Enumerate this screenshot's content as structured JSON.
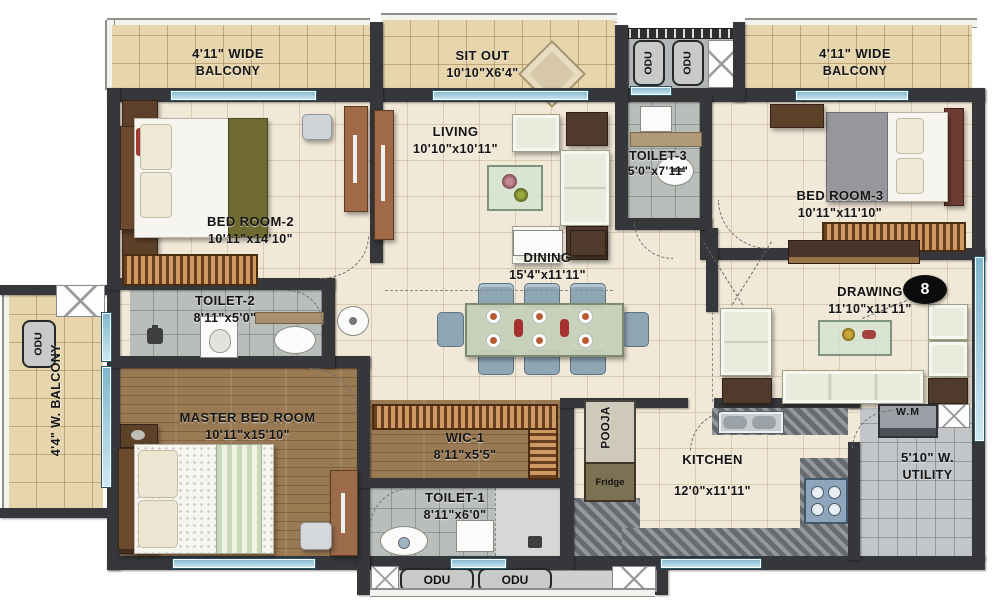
{
  "rooms": {
    "balcony_tl": {
      "label": "4'11\" WIDE",
      "sub": "BALCONY"
    },
    "sit_out": {
      "label": "SIT OUT",
      "sub": "10'10\"X6'4\""
    },
    "balcony_tr": {
      "label": "4'11\" WIDE",
      "sub": "BALCONY"
    },
    "living": {
      "label": "LIVING",
      "sub": "10'10\"x10'11\""
    },
    "toilet3": {
      "label": "TOILET-3",
      "sub": "5'0\"x7'11\""
    },
    "bedroom2": {
      "label": "BED ROOM-2",
      "sub": "10'11\"x14'10\""
    },
    "bedroom3": {
      "label": "BED ROOM-3",
      "sub": "10'11\"x11'10\""
    },
    "toilet2": {
      "label": "TOILET-2",
      "sub": "8'11\"x5'0\""
    },
    "dining": {
      "label": "DINING",
      "sub": "15'4\"x11'11\""
    },
    "drawing": {
      "label": "DRAWING",
      "sub": "11'10\"x11'11\""
    },
    "balcony_left": {
      "label": "4'4\" W. BALCONY"
    },
    "master": {
      "label": "MASTER BED ROOM",
      "sub": "10'11\"x15'10\""
    },
    "wic1": {
      "label": "WIC-1",
      "sub": "8'11\"x5'5\""
    },
    "toilet1": {
      "label": "TOILET-1",
      "sub": "8'11\"x6'0\""
    },
    "pooja": {
      "label": "POOJA"
    },
    "kitchen": {
      "label": "KITCHEN",
      "sub": "12'0\"x11'11\""
    },
    "utility": {
      "label": "5'10\" W.",
      "sub": "UTILITY"
    }
  },
  "markers": {
    "odu": "ODU",
    "fridge": "Fridge",
    "washing_machine": "W.M",
    "unit_number": "8"
  },
  "palette": {
    "wall": "#35373a",
    "floor_cream": "#f2e8d8",
    "floor_balcony": "#e7d6ad",
    "floor_toilet": "#babeba",
    "floor_utility": "#c2c6c9",
    "floor_wood": "#9a7a53",
    "window_glass": "#a9cfdf",
    "label_text": "#141414"
  }
}
